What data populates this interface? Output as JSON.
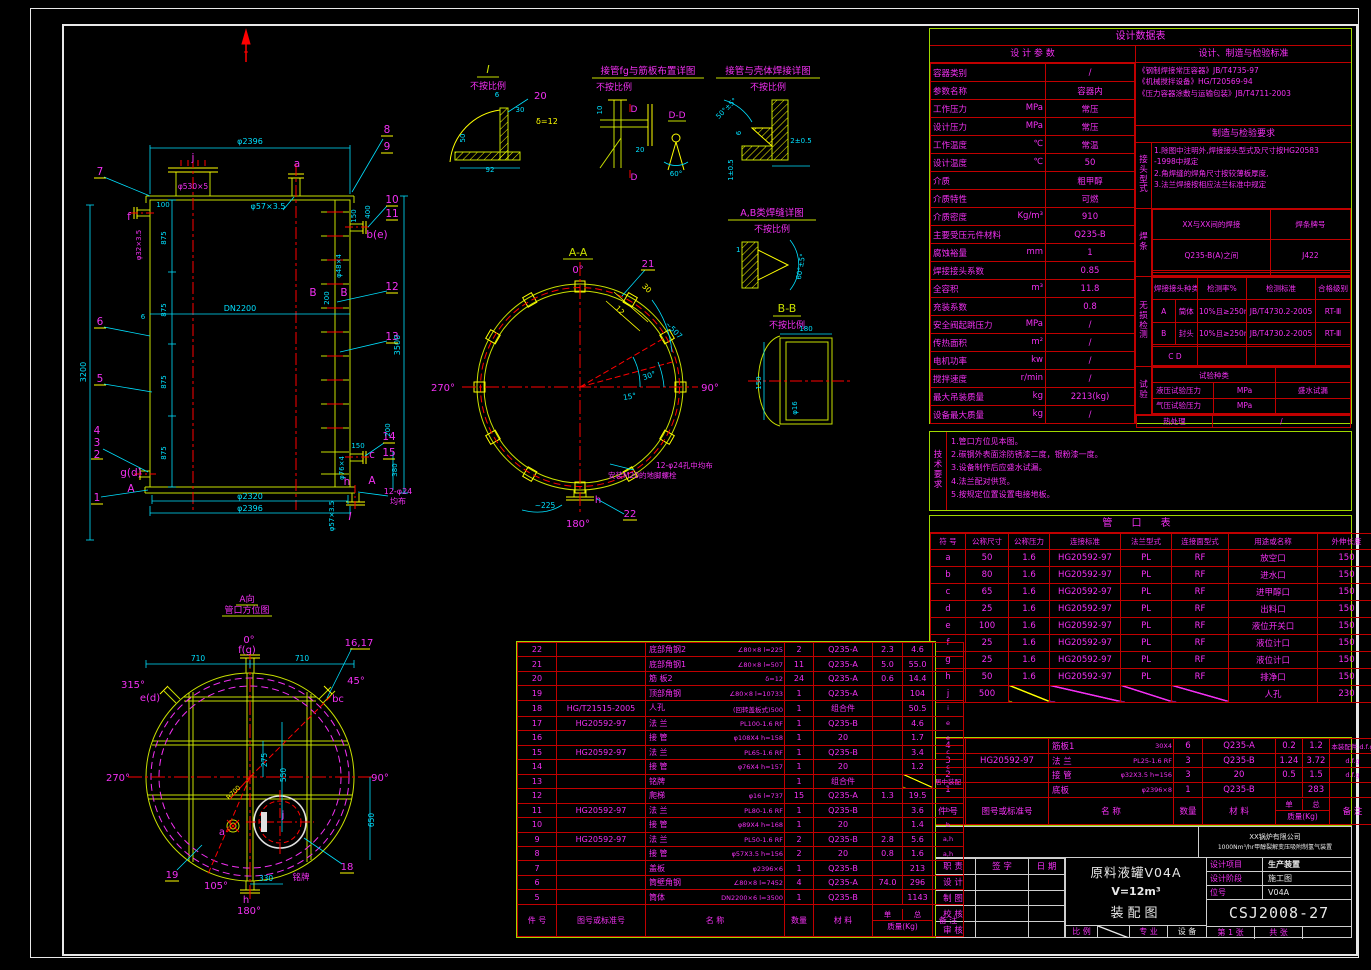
{
  "design_table": {
    "title": "设计数据表",
    "params_header": "设 计 参 数",
    "params": [
      {
        "label": "容器类别",
        "unit": "",
        "value": "/"
      },
      {
        "label": "参数名称",
        "unit": "",
        "value": "容器内"
      },
      {
        "label": "工作压力",
        "unit": "MPa",
        "value": "常压"
      },
      {
        "label": "设计压力",
        "unit": "MPa",
        "value": "常压"
      },
      {
        "label": "工作温度",
        "unit": "℃",
        "value": "常温"
      },
      {
        "label": "设计温度",
        "unit": "℃",
        "value": "50"
      },
      {
        "label": "介质",
        "unit": "",
        "value": "粗甲醇"
      },
      {
        "label": "介质特性",
        "unit": "",
        "value": "可燃"
      },
      {
        "label": "介质密度",
        "unit": "Kg/m³",
        "value": "910"
      },
      {
        "label": "主要受压元件材料",
        "unit": "",
        "value": "Q235-B"
      },
      {
        "label": "腐蚀裕量",
        "unit": "mm",
        "value": "1"
      },
      {
        "label": "焊接接头系数",
        "unit": "",
        "value": "0.85"
      },
      {
        "label": "全容积",
        "unit": "m³",
        "value": "11.8"
      },
      {
        "label": "充装系数",
        "unit": "",
        "value": "0.8"
      },
      {
        "label": "安全阀起跳压力",
        "unit": "MPa",
        "value": "/"
      },
      {
        "label": "传热面积",
        "unit": "m²",
        "value": "/"
      },
      {
        "label": "电机功率",
        "unit": "kw",
        "value": "/"
      },
      {
        "label": "搅拌速度",
        "unit": "r/min",
        "value": "/"
      },
      {
        "label": "最大吊装质量",
        "unit": "kg",
        "value": "2213(kg)"
      },
      {
        "label": "设备最大质量",
        "unit": "kg",
        "value": "/"
      }
    ],
    "standards_header": "设计、制造与检验标准",
    "standards": [
      "《钢制焊接常压容器》JB/T4735-97",
      "《机械搅拌设备》HG/T20569-94",
      "《压力容器涂敷与运输包装》JB/T4711-2003"
    ],
    "require_header": "制造与检验要求",
    "joint_label": "接头型式",
    "joint_notes": [
      "1.除图中注明外,焊接接头型式及尺寸按HG20583",
      "  -1998中规定",
      "2.角焊缝的焊角尺寸按较薄板厚度,",
      "3.法兰焊接按相应法兰标准中规定"
    ],
    "weld_label": "焊条",
    "weld_head": [
      "XX与XX间的焊接",
      "焊条牌号"
    ],
    "weld_row": [
      "Q235-B(A)之间",
      "J422"
    ],
    "ndt_label": "无损检测",
    "ndt_head": [
      "焊接接头种类",
      "检测率%",
      "检测标准",
      "合格级别"
    ],
    "ndt_rows": [
      [
        "A",
        "筒体",
        "10%且≥250mm",
        "JB/T4730.2-2005",
        "RT-Ⅲ"
      ],
      [
        "B",
        "封头",
        "10%且≥250mm",
        "JB/T4730.2-2005",
        "RT-Ⅲ"
      ]
    ],
    "ndt_cd": "C    D",
    "test_label": "试验",
    "test_type_header": "试验种类",
    "test_rows": [
      {
        "label": "液压试验压力",
        "unit": "MPa",
        "value": "盛水试漏"
      },
      {
        "label": "气压试验压力",
        "unit": "MPa",
        "value": ""
      }
    ],
    "heat_label": "热处理",
    "heat_value": "/"
  },
  "tech_notes": {
    "label": "技术要求",
    "items": [
      "1.管口方位见本图。",
      "2.碳钢外表面涂防锈漆二度，银粉漆一度。",
      "3.设备制作后应盛水试漏。",
      "4.法兰配对供货。",
      "5.按规定位置设置电接地板。"
    ]
  },
  "nozzle_table": {
    "title": "管    口    表",
    "headers": [
      "符 号",
      "公称尺寸",
      "公称压力",
      "连接标准",
      "法兰型式",
      "连接面型式",
      "用途或名称",
      "外伸长度"
    ],
    "rows": [
      [
        "a",
        "50",
        "1.6",
        "HG20592-97",
        "PL",
        "RF",
        "放空口",
        "150"
      ],
      [
        "b",
        "80",
        "1.6",
        "HG20592-97",
        "PL",
        "RF",
        "进水口",
        "150"
      ],
      [
        "c",
        "65",
        "1.6",
        "HG20592-97",
        "PL",
        "RF",
        "进甲醇口",
        "150"
      ],
      [
        "d",
        "25",
        "1.6",
        "HG20592-97",
        "PL",
        "RF",
        "出料口",
        "150"
      ],
      [
        "e",
        "100",
        "1.6",
        "HG20592-97",
        "PL",
        "RF",
        "液位开关口",
        "150"
      ],
      [
        "f",
        "25",
        "1.6",
        "HG20592-97",
        "PL",
        "RF",
        "液位计口",
        "150"
      ],
      [
        "g",
        "25",
        "1.6",
        "HG20592-97",
        "PL",
        "RF",
        "液位计口",
        "150"
      ],
      [
        "h",
        "50",
        "1.6",
        "HG20592-97",
        "PL",
        "RF",
        "排净口",
        "150"
      ],
      [
        "j",
        "500",
        "",
        "",
        "",
        "",
        "人孔",
        "230"
      ]
    ]
  },
  "bom_right": {
    "rows": [
      {
        "no": "4",
        "std": "",
        "name": "筋板1",
        "spec": "30X4",
        "qty": "6",
        "mat": "Q235-A",
        "u": "0.2",
        "t": "1.2",
        "rm": "本装配件 d.f.g"
      },
      {
        "no": "3",
        "std": "HG20592-97",
        "name": "法 兰",
        "spec": "PL25-1.6 RF",
        "qty": "3",
        "mat": "Q235-B",
        "u": "1.24",
        "t": "3.72",
        "rm": "d.f.g"
      },
      {
        "no": "2",
        "std": "",
        "name": "接 管",
        "spec": "φ32X3.5 h=156",
        "qty": "3",
        "mat": "20",
        "u": "0.5",
        "t": "1.5",
        "rm": "d.f.g"
      },
      {
        "no": "1",
        "std": "",
        "name": "底板",
        "spec": "φ2396×8",
        "qty": "1",
        "mat": "Q235-B",
        "u": "",
        "t": "283",
        "rm": ""
      }
    ],
    "headers": {
      "no": "件 号",
      "std": "图号或标准号",
      "name": "名  称",
      "qty": "数量",
      "mat": "材 料",
      "unit": "单",
      "total": "总",
      "mass": "质量(Kg)",
      "remark": "备 注"
    }
  },
  "bom_main": {
    "rows": [
      {
        "no": "22",
        "std": "",
        "name": "底部角钢2",
        "spec": "∠80×8  l≈225",
        "qty": "2",
        "mat": "Q235-A",
        "u": "2.3",
        "t": "4.6",
        "rm": ""
      },
      {
        "no": "21",
        "std": "",
        "name": "底部角钢1",
        "spec": "∠80×8  l≈507",
        "qty": "11",
        "mat": "Q235-A",
        "u": "5.0",
        "t": "55.0",
        "rm": ""
      },
      {
        "no": "20",
        "std": "",
        "name": "筋 板2",
        "spec": "δ=12",
        "qty": "24",
        "mat": "Q235-A",
        "u": "0.6",
        "t": "14.4",
        "rm": ""
      },
      {
        "no": "19",
        "std": "",
        "name": "顶部角钢",
        "spec": "∠80×8  l≈10733",
        "qty": "1",
        "mat": "Q235-A",
        "u": "",
        "t": "104",
        "rm": ""
      },
      {
        "no": "18",
        "std": "HG/T21515-2005",
        "name": "人孔",
        "spec": "(回转盖板式)500",
        "qty": "1",
        "mat": "组合件",
        "u": "",
        "t": "50.5",
        "rm": "i"
      },
      {
        "no": "17",
        "std": "HG20592-97",
        "name": "法 兰",
        "spec": "PL100-1.6  RF",
        "qty": "1",
        "mat": "Q235-B",
        "u": "",
        "t": "4.6",
        "rm": "e"
      },
      {
        "no": "16",
        "std": "",
        "name": "接 管",
        "spec": "φ108X4  h=158",
        "qty": "1",
        "mat": "20",
        "u": "",
        "t": "1.7",
        "rm": "e"
      },
      {
        "no": "15",
        "std": "HG20592-97",
        "name": "法 兰",
        "spec": "PL65-1.6  RF",
        "qty": "1",
        "mat": "Q235-B",
        "u": "",
        "t": "3.4",
        "rm": "c"
      },
      {
        "no": "14",
        "std": "",
        "name": "接 管",
        "spec": "φ76X4  h=157",
        "qty": "1",
        "mat": "20",
        "u": "",
        "t": "1.2",
        "rm": "c"
      },
      {
        "no": "13",
        "std": "",
        "name": "铭牌",
        "spec": "",
        "qty": "1",
        "mat": "组合件",
        "u": "",
        "t": "/",
        "rm": "居中装配"
      },
      {
        "no": "12",
        "std": "",
        "name": "爬梯",
        "spec": "φ16  l≈737",
        "qty": "15",
        "mat": "Q235-A",
        "u": "1.3",
        "t": "19.5",
        "rm": ""
      },
      {
        "no": "11",
        "std": "HG20592-97",
        "name": "法 兰",
        "spec": "PL80-1.6  RF",
        "qty": "1",
        "mat": "Q235-B",
        "u": "",
        "t": "3.6",
        "rm": "b"
      },
      {
        "no": "10",
        "std": "",
        "name": "接 管",
        "spec": "φ89X4  h=168",
        "qty": "1",
        "mat": "20",
        "u": "",
        "t": "1.4",
        "rm": "b"
      },
      {
        "no": "9",
        "std": "HG20592-97",
        "name": "法 兰",
        "spec": "PL50-1.6  RF",
        "qty": "2",
        "mat": "Q235-B",
        "u": "2.8",
        "t": "5.6",
        "rm": "a,h"
      },
      {
        "no": "8",
        "std": "",
        "name": "接 管",
        "spec": "φ57X3.5  h=156",
        "qty": "2",
        "mat": "20",
        "u": "0.8",
        "t": "1.6",
        "rm": "a,h"
      },
      {
        "no": "7",
        "std": "",
        "name": "盖板",
        "spec": "φ2396×6",
        "qty": "1",
        "mat": "Q235-B",
        "u": "",
        "t": "213",
        "rm": ""
      },
      {
        "no": "6",
        "std": "",
        "name": "筒壁角钢",
        "spec": "∠80×8  l=7452",
        "qty": "4",
        "mat": "Q235-A",
        "u": "74.0",
        "t": "296",
        "rm": ""
      },
      {
        "no": "5",
        "std": "",
        "name": "筒体",
        "spec": "DN2200×6  l=3500",
        "qty": "1",
        "mat": "Q235-B",
        "u": "",
        "t": "1143",
        "rm": ""
      }
    ],
    "headers": {
      "no": "件 号",
      "std": "图号或标准号",
      "name": "名  称",
      "qty": "数量",
      "mat": "材 料",
      "unit": "单",
      "total": "总",
      "mass": "质量(Kg)",
      "remark": "备 注"
    }
  },
  "title_block": {
    "company_line1": "XX锅炉有限公司",
    "company_line2": "1000Nm³/hr甲醇裂解变压吸附制氢气装置",
    "resp_headers": [
      "职  责",
      "签  字",
      "日  期"
    ],
    "resp_rows": [
      "设  计",
      "制  图",
      "校  核",
      "审  核"
    ],
    "title_line1": "原料液罐V04A",
    "title_line2": "V=12m³",
    "title_line3": "装配图",
    "fields": [
      {
        "label": "设计项目",
        "value": "生产装置"
      },
      {
        "label": "设计阶段",
        "value": "施工图"
      },
      {
        "label": "位号",
        "value": "V04A"
      }
    ],
    "drawing_no": "CSJ2008-27",
    "scale_label": "比 例",
    "major_label": "专 业",
    "major_value": "设 备",
    "sheet_label": "第 1 张",
    "total_label": "共  张"
  },
  "drawing": {
    "front": {
      "n1": "1",
      "n2": "2",
      "n3": "3",
      "n4": "4",
      "n5": "5",
      "n6": "6",
      "n7": "7",
      "n8": "8",
      "n9": "9",
      "n10": "10",
      "n11": "11",
      "n12": "12",
      "n13": "13",
      "n14": "14",
      "n15": "15",
      "j": "j",
      "a": "a",
      "f": "f",
      "be": "b(e)",
      "gd": "g(d)",
      "c": "c",
      "h": "h",
      "A": "A",
      "B": "B",
      "I_mark": "I",
      "d2396t": "φ2396",
      "d530": "φ530×5",
      "d57": "φ57×3.5",
      "d32": "φ32×3.5",
      "d100": "100",
      "d875": "875",
      "d3200": "3200",
      "dDN2200": "DN2200",
      "d6": "6",
      "d3500": "3500",
      "d200": "200",
      "d150": "150",
      "d400": "400",
      "d48": "φ48×4",
      "d76": "φ76×4",
      "d380": "380",
      "d2320": "φ2320",
      "d2396b": "φ2396",
      "d1224": "12-φ24",
      "djb": "均布"
    },
    "section_aa": {
      "title": "A-A",
      "a0": "0°",
      "a90": "90°",
      "a180": "180°",
      "a270": "270°",
      "c21": "21",
      "c22": "22",
      "h": "h",
      "d507": "~507",
      "d12": "12",
      "d30": "30",
      "a30": "30°",
      "a15": "15°",
      "d225": "~225",
      "note1": "12-φ24孔中均布",
      "note2": "安装M20的地脚螺栓"
    },
    "view_a": {
      "t1": "A向",
      "t2": "管口方位图",
      "a0": "0°",
      "a45": "45°",
      "a90": "90°",
      "a105": "105°",
      "a180": "180°",
      "a270": "270°",
      "a315": "315°",
      "fg": "f(g)",
      "ed": "e(d)",
      "bc": "bc",
      "a": "a",
      "j": "j",
      "h": "h",
      "c1617": "16,17",
      "c18": "18",
      "c19": "19",
      "mp": "铭牌",
      "d710": "710",
      "d275": "275",
      "d550": "550",
      "d650": "650",
      "d330": "330",
      "r700": "R700"
    },
    "details": {
      "i": {
        "t": "I",
        "nts": "不按比例",
        "c20": "20",
        "delta": "δ=12",
        "d6": "6",
        "d30": "30",
        "d92": "92",
        "d50": "50"
      },
      "fg": {
        "t": "接管fg与筋板布置详图",
        "nts": "不按比例",
        "d": "D",
        "dd": "D-D",
        "d10": "10",
        "d20": "20",
        "a60": "60°"
      },
      "sw": {
        "t": "接管与壳体焊接详图",
        "nts": "不按比例",
        "a50": "50°±5°",
        "d2": "2±0.5",
        "d1": "1±0.5",
        "d6": "6"
      },
      "ab": {
        "t": "A,B类焊缝详图",
        "nts": "不按比例",
        "a60": "60°±5°",
        "d1": "1"
      },
      "bb": {
        "t": "B-B",
        "nts": "不按比例",
        "d180": "180",
        "d150": "150",
        "d16": "φ16"
      }
    }
  }
}
